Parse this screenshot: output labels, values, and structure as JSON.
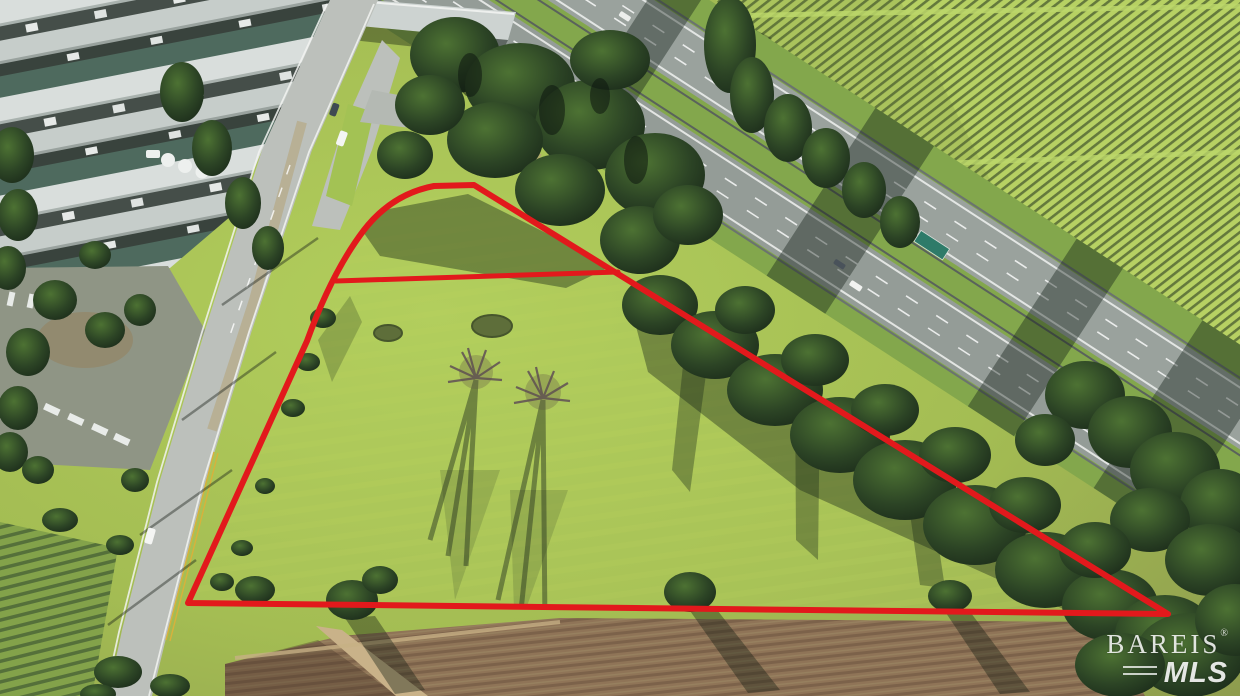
{
  "watermark": {
    "brand": "BAREIS",
    "registered": "®",
    "sub": "MLS"
  },
  "colors": {
    "boundary_red": "#e2191c",
    "parcel_grass": "#aac654",
    "outer_grass": "#9cb052",
    "vineyard_row": "#b7d163",
    "vineyard_gap": "#64793c",
    "tree_dark": "#22331f",
    "highway_asphalt": "#99a19c",
    "local_road": "#bcc0bb",
    "median_grass": "#87a24c",
    "plowed_brown": "#8a7054",
    "roof_light": "#d9dedc"
  },
  "boundary": {
    "outer_path": "M 188 603 L 307 341 Q 332 272 364 230 Q 392 194 434 186 L 474 185 L 1168 614 Z",
    "divider_path": "M 336 281 L 618 272",
    "stroke_width": "6"
  }
}
